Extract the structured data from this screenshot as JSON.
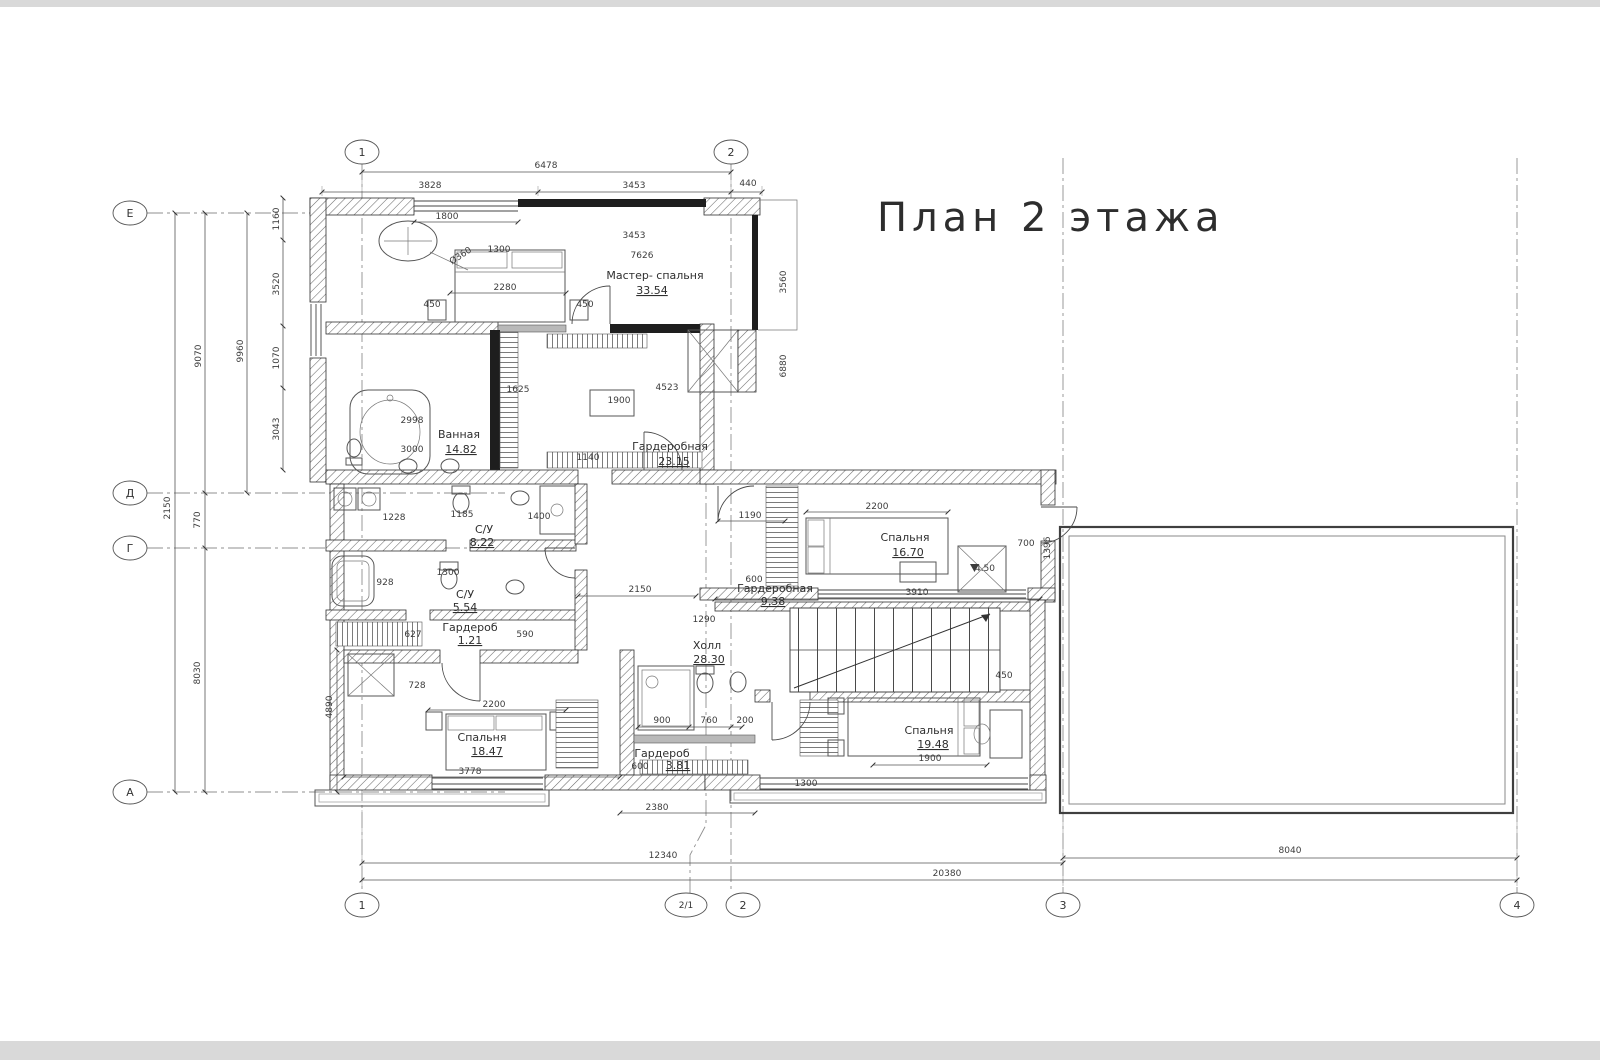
{
  "title": "План 2 этажа",
  "colors": {
    "line": "#3a3a3a",
    "hatch": "#6b6b6b",
    "dark_fill": "#1e1e1e",
    "axis_line": "#8f8f8f",
    "dim_text": "#3c3c3c",
    "page_edge": "#d9d9d9",
    "background": "#ffffff"
  },
  "axes": {
    "top": [
      "1",
      "2"
    ],
    "bottom": [
      "1",
      "2/1",
      "2",
      "3",
      "4"
    ],
    "left": [
      "Е",
      "Д",
      "Г",
      "А"
    ]
  },
  "rooms": {
    "master_bedroom": {
      "name": "Мастер- спальня",
      "area": "33.54"
    },
    "bathroom": {
      "name": "Ванная",
      "area": "14.82"
    },
    "wardrobe_master": {
      "name": "Гардеробная",
      "area": "23.15"
    },
    "bedroom_right": {
      "name": "Спальня",
      "area": "16.70"
    },
    "wardrobe_right": {
      "name": "Гардеробная",
      "area": "9.38"
    },
    "hall": {
      "name": "Холл",
      "area": "28.30"
    },
    "bedroom_left": {
      "name": "Спальня",
      "area": "18.47"
    },
    "wardrobe_lower": {
      "name": "Гардероб",
      "area": "3.81"
    },
    "bedroom_lower_right": {
      "name": "Спальня",
      "area": "19.48"
    },
    "wc_upper": {
      "name": "С/У",
      "area": "8.22"
    },
    "wc_lower": {
      "name": "С/У",
      "area": "5.54"
    },
    "wardrobe_small": {
      "name": "Гардероб",
      "area": "1.21"
    }
  },
  "dims": {
    "top_total": "6478",
    "top_a": "3828",
    "top_b": "3453",
    "top_c": "440",
    "bottom_a": "12340",
    "bottom_b": "20380",
    "bottom_c": "8040",
    "win_top": "1800",
    "d1300a": "1300",
    "d3453": "3453",
    "d7626": "7626",
    "d2280": "2280",
    "d450a": "450",
    "d450b": "450",
    "dia": "Ø360",
    "d2998": "2998",
    "d3000": "3000",
    "d1625": "1625",
    "d4523": "4523",
    "d1900a": "1900",
    "d1140": "1140",
    "d1190": "1190",
    "d2200a": "2200",
    "d700a": "700",
    "d3910": "3910",
    "d600a": "600",
    "lvl": "4.50",
    "d450c": "450",
    "d2150": "2150",
    "d1290": "1290",
    "d1228": "1228",
    "d1185": "1185",
    "d1400": "1400",
    "d928": "928",
    "d1300b": "1300",
    "d627": "627",
    "d590": "590",
    "d728": "728",
    "d2200b": "2200",
    "d3778": "3778",
    "d900": "900",
    "d760": "760",
    "d200": "200",
    "d600b": "600",
    "d2380": "2380",
    "d1900b": "1900",
    "d1300c": "1300",
    "v9070": "9070",
    "v9960": "9960",
    "v1160": "1160",
    "v3520": "3520",
    "v1070": "1070",
    "v3043": "3043",
    "v2150": "2150",
    "v770": "770",
    "v8030": "8030",
    "v4890": "4890",
    "v3560": "3560",
    "v6880": "6880",
    "v1396": "1396"
  }
}
